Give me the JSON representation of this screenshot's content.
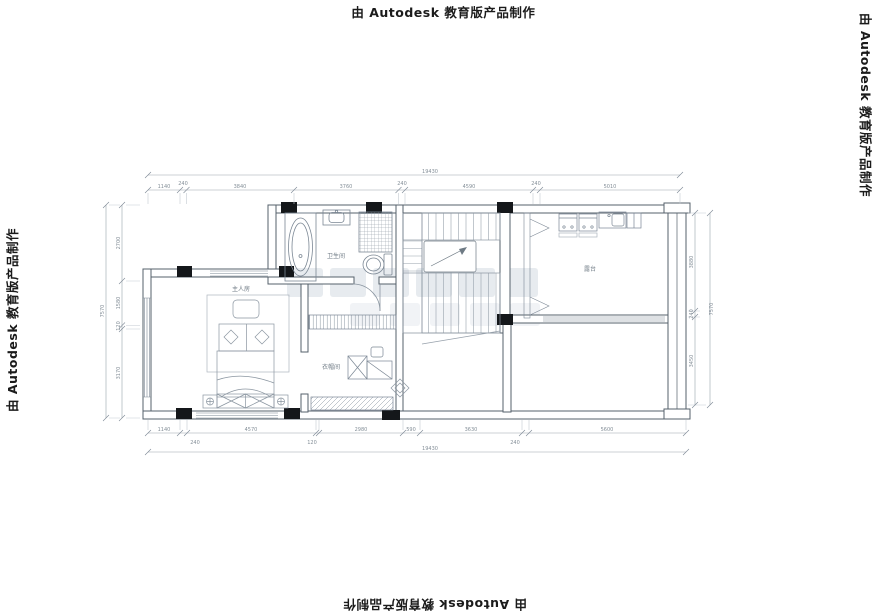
{
  "watermark": {
    "text": "由 Autodesk 教育版产品制作"
  },
  "rooms": {
    "master_bedroom": "主人房",
    "bathroom": "卫生间",
    "closet": "衣帽间",
    "terrace": "露台"
  },
  "dimensions": {
    "top": {
      "total": "19430",
      "segments": [
        "1140",
        "240",
        "3840",
        "3760",
        "240",
        "4590",
        "240",
        "5010"
      ]
    },
    "bottom": {
      "total": "19430",
      "segments": [
        "1140",
        "4570",
        "2980",
        "590",
        "3630",
        "5600"
      ],
      "sub": [
        "240",
        "120",
        "240"
      ]
    },
    "left": {
      "total": "7570",
      "segments": [
        "2700",
        "1580",
        "120",
        "3170"
      ]
    },
    "right": {
      "total": "7570",
      "segments": [
        "3880",
        "240",
        "3450"
      ]
    }
  },
  "colors": {
    "wall": "#55606b",
    "fixture": "#7b8794",
    "dim_line": "#9aa4ad",
    "dim_text": "#848f98",
    "column": "#14171a"
  }
}
